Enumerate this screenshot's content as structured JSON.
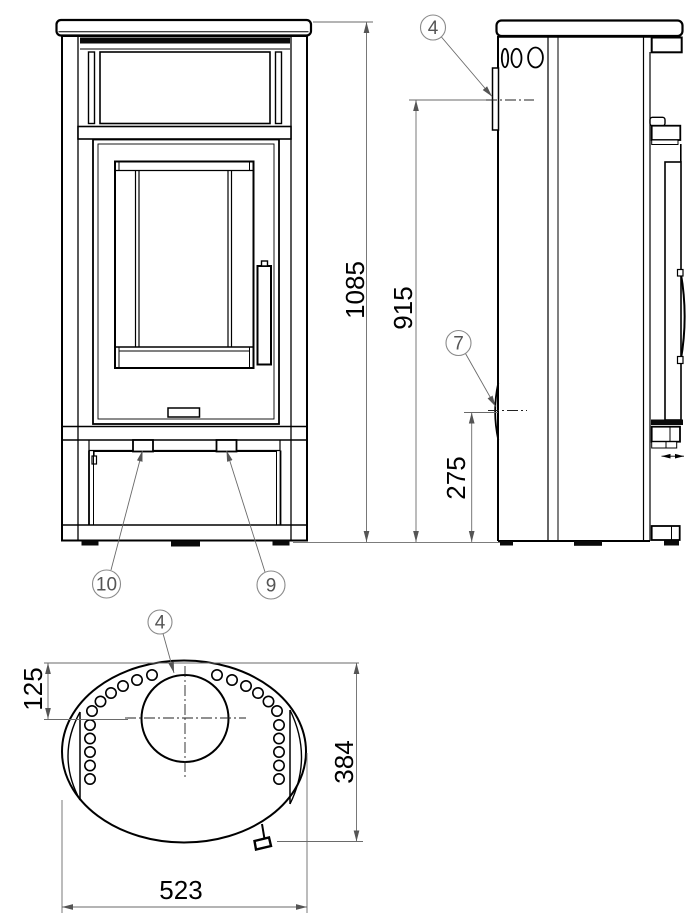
{
  "dimensions": {
    "overall_height": "1085",
    "rear_upper_height": "915",
    "rear_lower_height": "275",
    "flue_offset": "125",
    "depth": "384",
    "width": "523"
  },
  "callouts": {
    "item4_side": "4",
    "item7": "7",
    "item9": "9",
    "item10": "10",
    "item4_top": "4"
  }
}
